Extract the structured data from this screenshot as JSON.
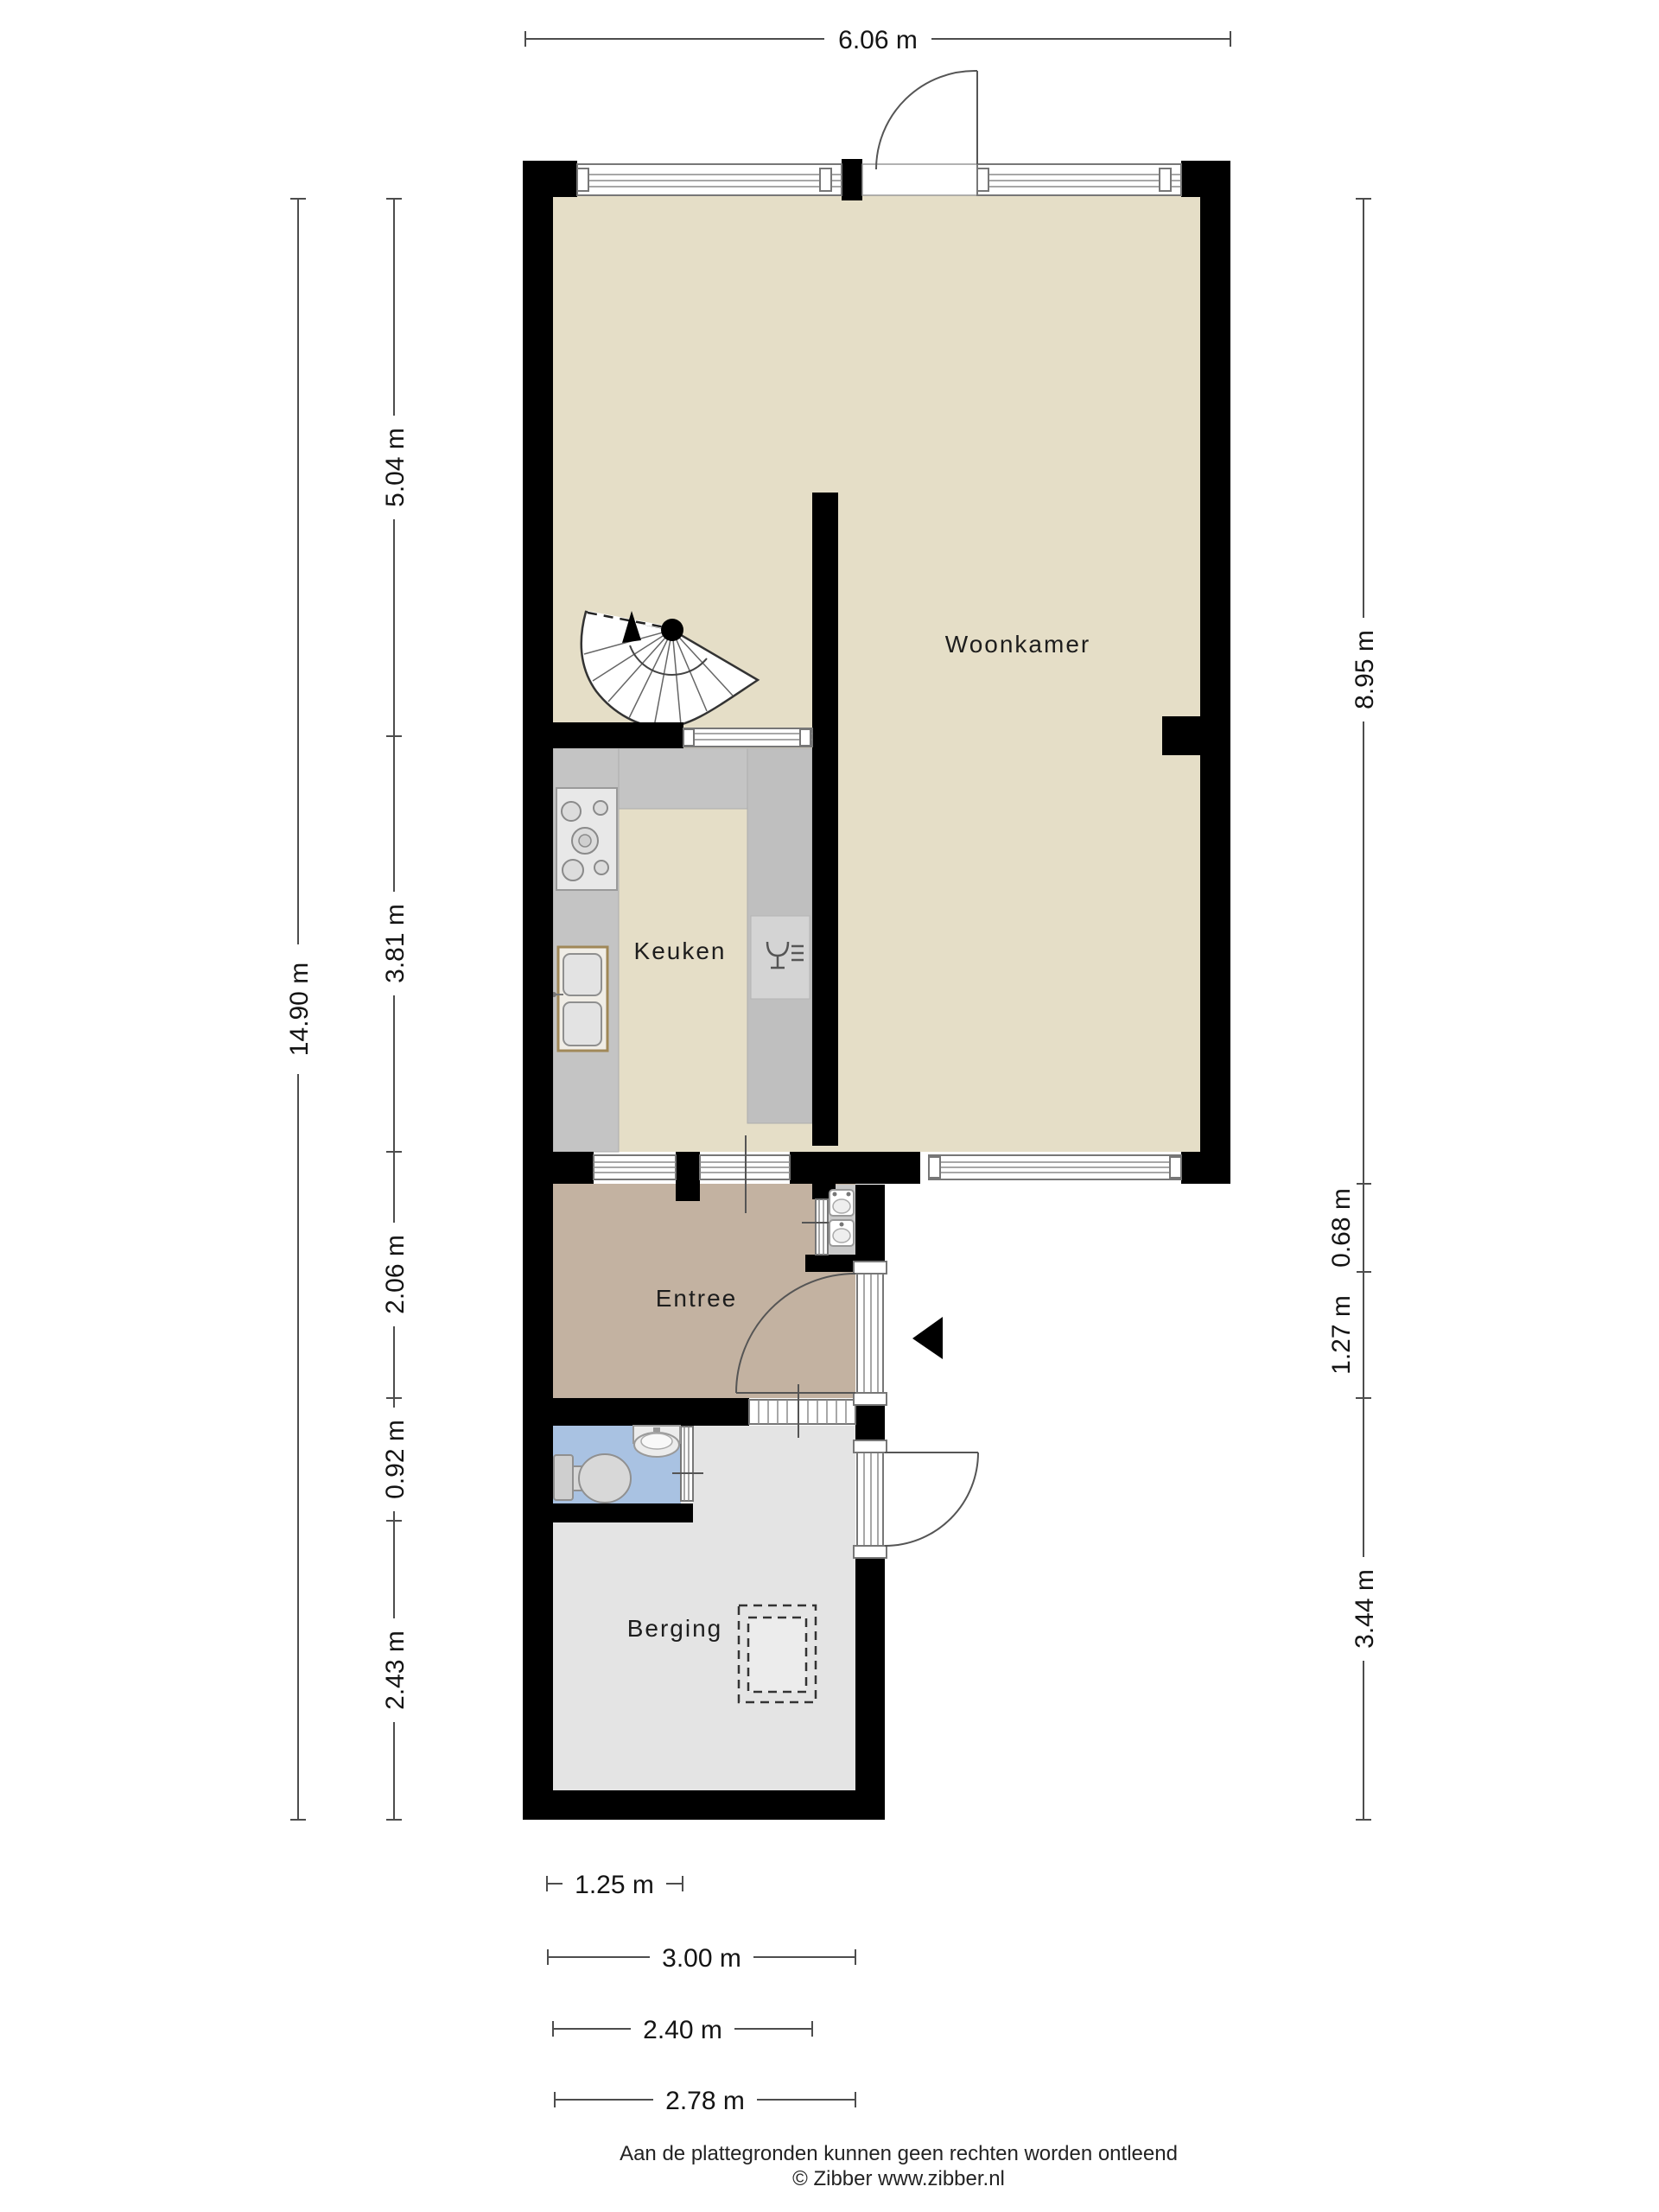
{
  "floorplan": {
    "rooms": [
      {
        "label": "Woonkamer"
      },
      {
        "label": "Keuken"
      },
      {
        "label": "Entree"
      },
      {
        "label": "Berging"
      }
    ],
    "dimensions": {
      "top": "6.06 m",
      "left_total": "14.90 m",
      "left": [
        "5.04 m",
        "3.81 m",
        "2.06 m",
        "0.92 m",
        "2.43 m"
      ],
      "right": [
        "8.95 m",
        "0.68 m",
        "1.27 m",
        "3.44 m"
      ],
      "bottom": [
        "1.25 m",
        "3.00 m",
        "2.40 m",
        "2.78 m"
      ]
    },
    "footer": {
      "disclaimer": "Aan de plattegronden kunnen geen rechten worden ontleend",
      "credit": "© Zibber www.zibber.nl"
    },
    "colors": {
      "wall": "#000000",
      "floor_living": "#e5dec7",
      "floor_entry": "#c3b2a1",
      "floor_toilet": "#a9c2e2",
      "floor_storage": "#e4e4e4",
      "counter": "#c4c4c4",
      "dimension_text": "#141414"
    }
  }
}
